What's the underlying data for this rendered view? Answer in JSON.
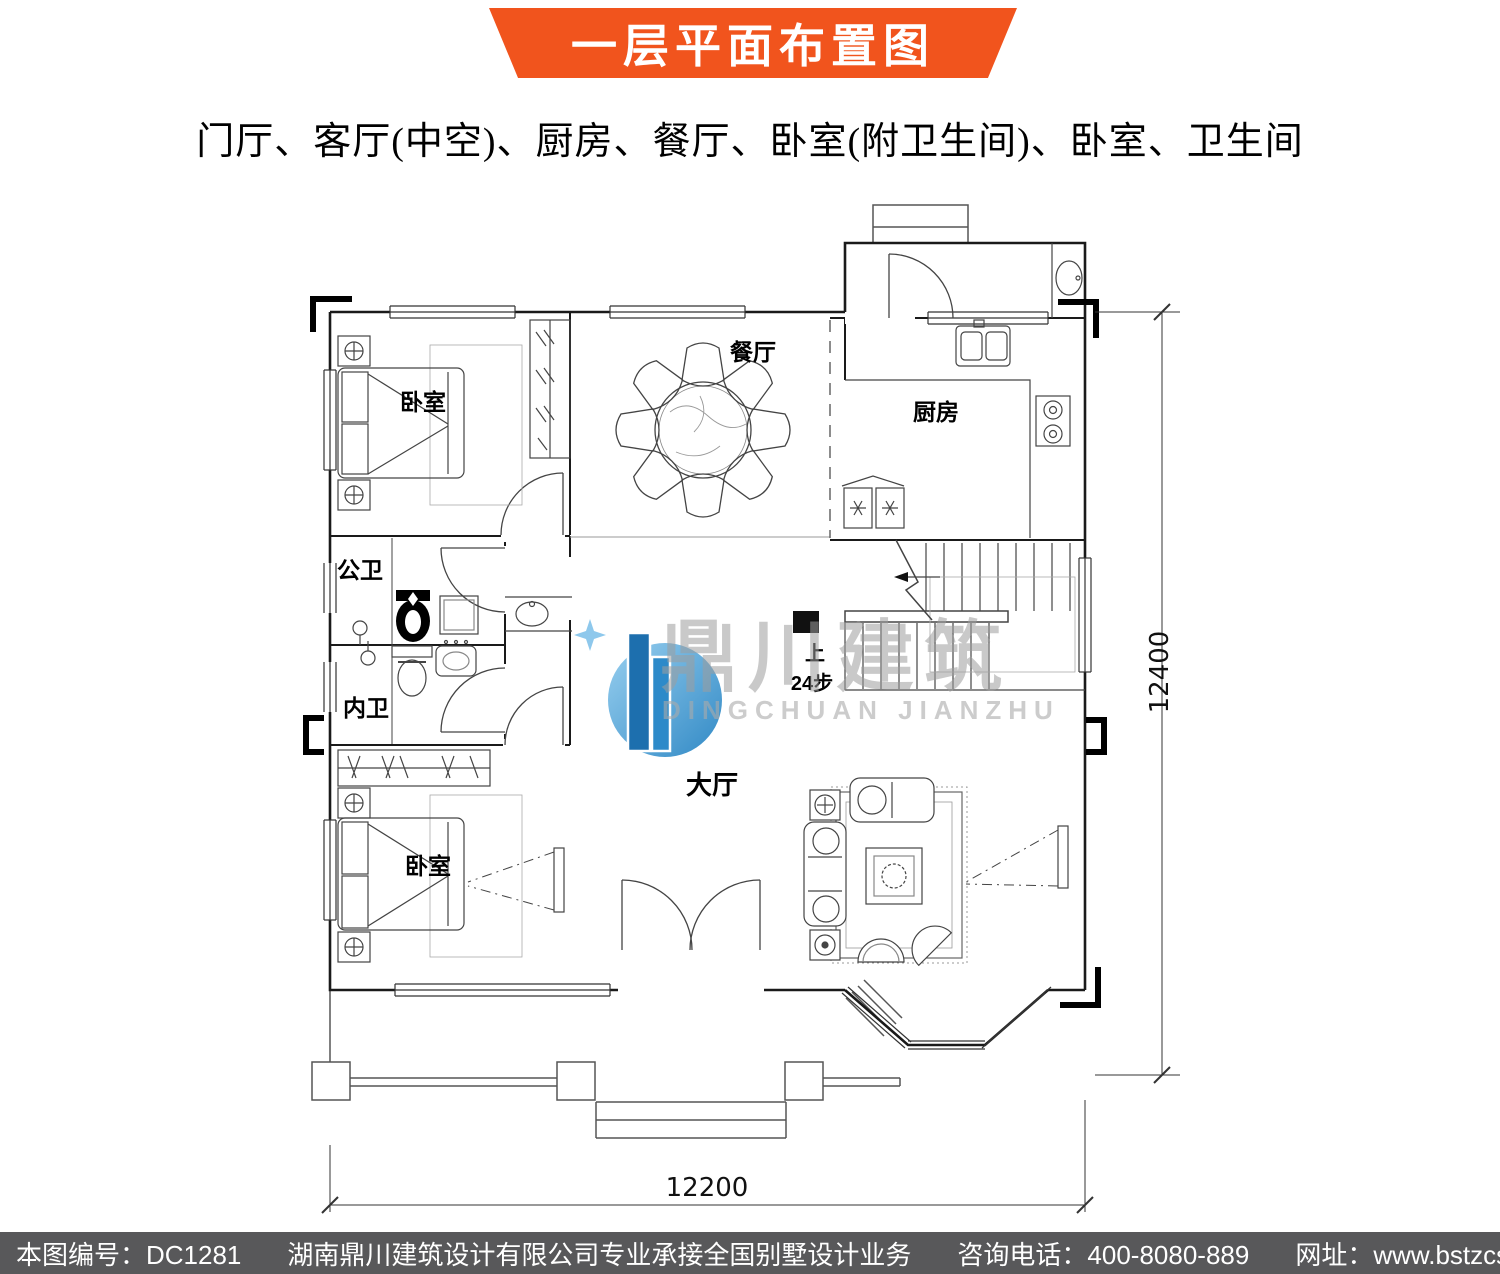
{
  "banner": {
    "title": "一层平面布置图",
    "color": "#f1541d"
  },
  "subtitle": "门厅、客厅(中空)、厨房、餐厅、卧室(附卫生间)、卧室、卫生间",
  "watermark": {
    "cn": "鼎川建筑",
    "en": "DINGCHUAN JIANZHU",
    "logo_blue": "#3c9ad6"
  },
  "plan": {
    "rooms": [
      {
        "label": "卧室"
      },
      {
        "label": "餐厅"
      },
      {
        "label": "厨房"
      },
      {
        "label": "公卫"
      },
      {
        "label": "内卫"
      },
      {
        "label": "卧室"
      },
      {
        "label": "大厅"
      }
    ],
    "stairs": {
      "up_label": "上",
      "steps_label": "24步"
    },
    "dimensions": {
      "right": "12400",
      "bottom": "12200"
    }
  },
  "footer": {
    "drawing_no": "本图编号：DC1281",
    "company": "湖南鼎川建筑设计有限公司专业承接全国别墅设计业务",
    "phone": "咨询电话：400-8080-889",
    "website": "网址：www.bstzcs.com",
    "bg": "#58585a"
  }
}
